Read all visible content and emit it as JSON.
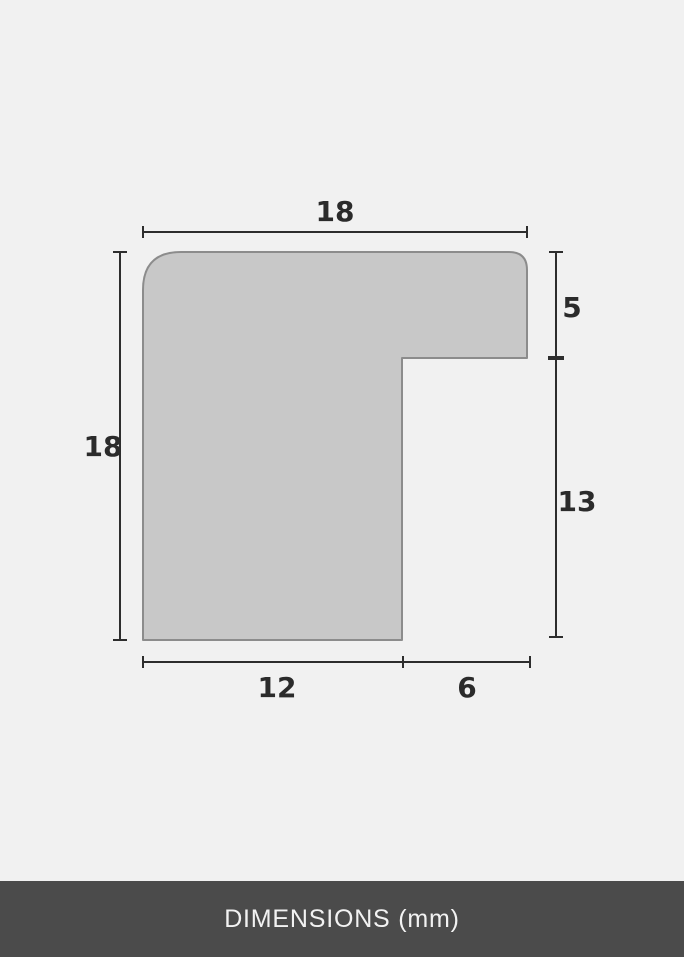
{
  "diagram": {
    "labels": {
      "top_width": "18",
      "left_height": "18",
      "right_upper": "5",
      "right_lower": "13",
      "bottom_left": "12",
      "bottom_right": "6"
    },
    "colors": {
      "background": "#f1f1f1",
      "shape_fill": "#c8c8c8",
      "shape_outline": "#8c8c8c",
      "dimension_line": "#2d2d2d",
      "label_text": "#2b2b2b",
      "footer_background": "#4b4b4b",
      "footer_text": "#f2f2f2"
    }
  },
  "footer": {
    "label": "DIMENSIONS (mm)"
  }
}
